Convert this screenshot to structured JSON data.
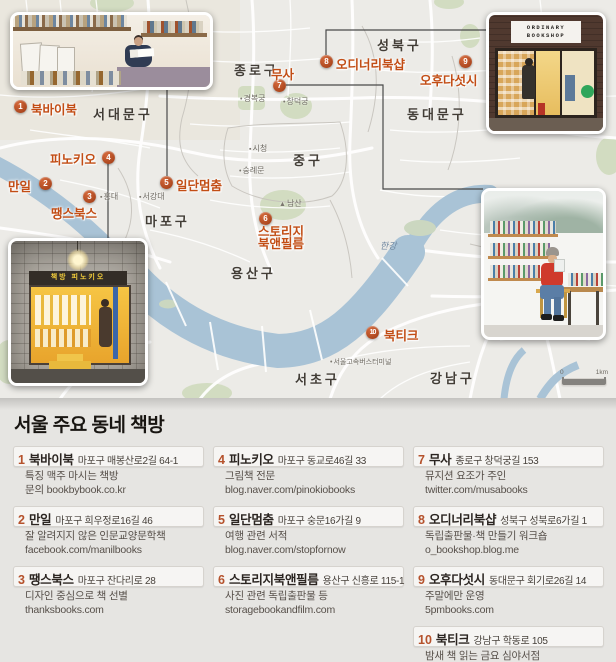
{
  "map": {
    "districts": [
      "서대문구",
      "종로구",
      "성북구",
      "동대문구",
      "중구",
      "마포구",
      "용산구",
      "서초구",
      "강남구"
    ],
    "pois": {
      "gyeongbokgung": "경복궁",
      "changdeokgung": "창덕궁",
      "cityhall": "시청",
      "sungnyemun": "숭례문",
      "hongdae": "홍대",
      "sogang": "서강대",
      "namsan": "남산",
      "hangang": "한강",
      "express_terminal": "서울고속버스터미널"
    },
    "scale": {
      "start": "0",
      "end": "1km"
    },
    "markers": [
      {
        "num": "1",
        "label": "북바이북"
      },
      {
        "num": "2",
        "label": "만일"
      },
      {
        "num": "3",
        "label": "땡스북스"
      },
      {
        "num": "4",
        "label": "피노키오"
      },
      {
        "num": "5",
        "label": "일단멈춤"
      },
      {
        "num": "6",
        "label": "스토리지",
        "label2": "북앤필름"
      },
      {
        "num": "7",
        "label": "무사"
      },
      {
        "num": "8",
        "label": "오디너리북샵"
      },
      {
        "num": "9",
        "label": "오후다섯시"
      },
      {
        "num": "10",
        "label": "북티크"
      }
    ],
    "photo_signs": {
      "ordinary_line1": "ORDINARY",
      "ordinary_line2": "BOOKSHOP",
      "pinocchio": "책방 피노키오"
    }
  },
  "legend": {
    "title": "서울 주요 동네 책방",
    "entries": [
      {
        "num": "1",
        "name": "북바이북",
        "address": "마포구 매봉산로2길 64-1",
        "desc1": "특징 맥주 마시는 책방",
        "desc2": "문의 bookbybook.co.kr"
      },
      {
        "num": "2",
        "name": "만일",
        "address": "마포구 희우정로16길 46",
        "desc1": "잘 알려지지 않은 인문교양문학책",
        "desc2": "facebook.com/manilbooks"
      },
      {
        "num": "3",
        "name": "땡스북스",
        "address": "마포구 잔다리로 28",
        "desc1": "디자인 중심으로 책 선별",
        "desc2": "thanksbooks.com"
      },
      {
        "num": "4",
        "name": "피노키오",
        "address": "마포구 동교로46길 33",
        "desc1": "그림책 전문",
        "desc2": "blog.naver.com/pinokiobooks"
      },
      {
        "num": "5",
        "name": "일단멈춤",
        "address": "마포구 숭문16가길 9",
        "desc1": "여행 관련 서적",
        "desc2": "blog.naver.com/stopfornow"
      },
      {
        "num": "6",
        "name": "스토리지북앤필름",
        "address": "용산구 신흥로 115-1",
        "desc1": "사진 관련 독립출판물 등",
        "desc2": "storagebookandfilm.com"
      },
      {
        "num": "7",
        "name": "무사",
        "address": "종로구 창덕궁길 153",
        "desc1": "뮤지션 요조가 주인",
        "desc2": "twitter.com/musabooks"
      },
      {
        "num": "8",
        "name": "오디너리북샵",
        "address": "성북구 성북로6가길 1",
        "desc1": "독립출판물·책 만들기 워크숍",
        "desc2": "o_bookshop.blog.me"
      },
      {
        "num": "9",
        "name": "오후다섯시",
        "address": "동대문구 회기로26길 14",
        "desc1": "주말에만 운영",
        "desc2": "5pmbooks.com"
      },
      {
        "num": "10",
        "name": "북티크",
        "address": "강남구 학동로 105",
        "desc1": "밤새 책 읽는 금요 심야서점",
        "desc2": "booktique.kr"
      }
    ]
  },
  "colors": {
    "marker": "#9c3a14",
    "marker_label": "#c24d15",
    "land": "#ecebe7",
    "water": "#a9c3d6",
    "park": "#d2dcc1",
    "legend_bg": "#e6e5e2",
    "accent": "#b5522c"
  }
}
